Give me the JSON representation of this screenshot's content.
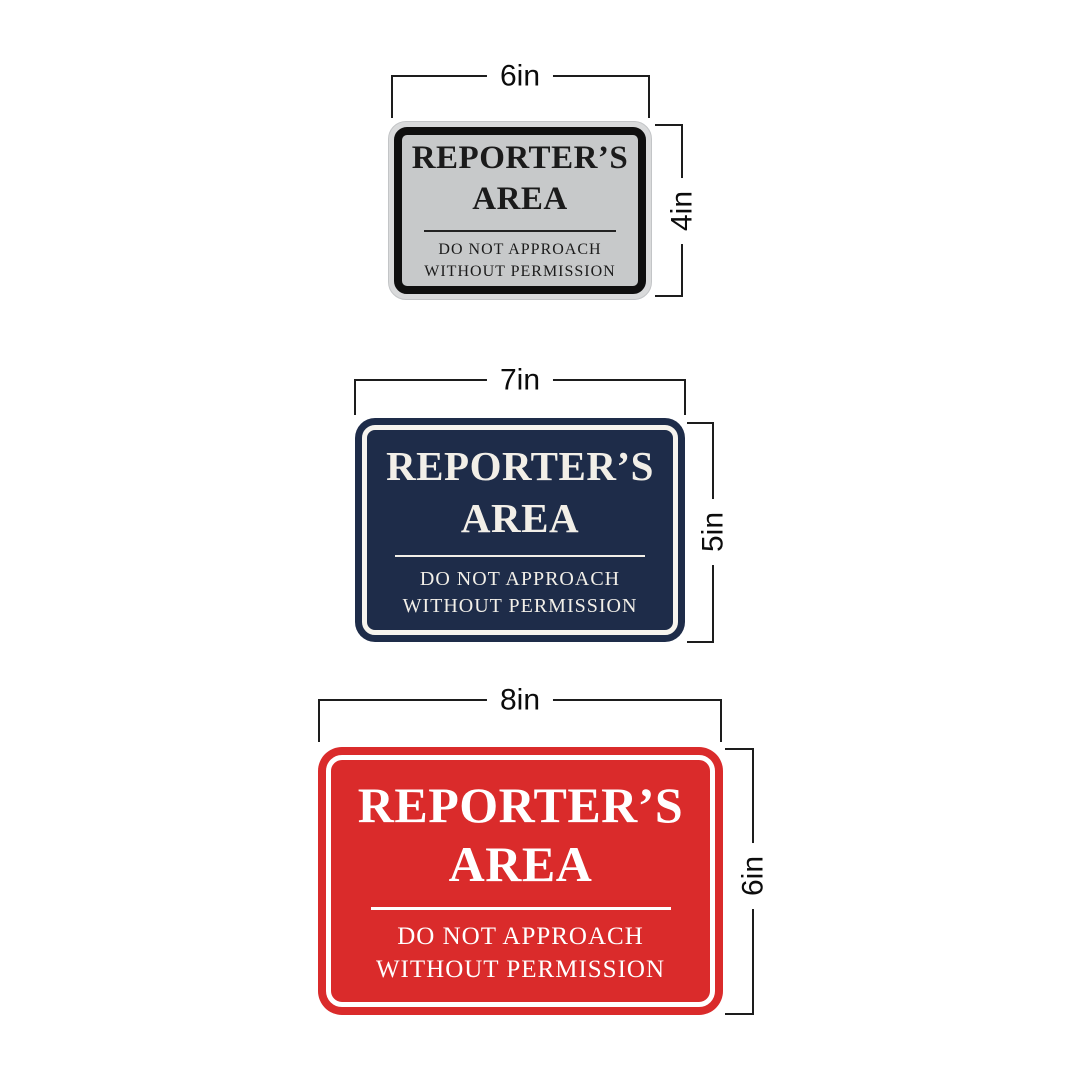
{
  "canvas": {
    "background": "#ffffff",
    "dimension_line_color": "#1d1d1d",
    "dimension_label_color": "#0c0c0c"
  },
  "signs": [
    {
      "name": "silver-sign-6x4",
      "width_label": "6in",
      "height_label": "4in",
      "title_line1": "REPORTER’S",
      "title_line2": "AREA",
      "subtitle_line1": "DO NOT APPROACH",
      "subtitle_line2": "WITHOUT PERMISSION",
      "colors": {
        "frame": "#d9dadb",
        "border": "#0f0f0f",
        "face": "#c7c9ca",
        "text": "#1b1b1b",
        "divider": "#222222"
      }
    },
    {
      "name": "navy-sign-7x5",
      "width_label": "7in",
      "height_label": "5in",
      "title_line1": "REPORTER’S",
      "title_line2": "AREA",
      "subtitle_line1": "DO NOT APPROACH",
      "subtitle_line2": "WITHOUT PERMISSION",
      "colors": {
        "face": "#1e2c49",
        "stripe": "#f7f4ee",
        "text": "#f2efe8",
        "divider": "#f2efe8"
      }
    },
    {
      "name": "red-sign-8x6",
      "width_label": "8in",
      "height_label": "6in",
      "title_line1": "REPORTER’S",
      "title_line2": "AREA",
      "subtitle_line1": "DO NOT APPROACH",
      "subtitle_line2": "WITHOUT PERMISSION",
      "colors": {
        "face": "#da2b2b",
        "stripe": "#ffffff",
        "text": "#ffffff",
        "divider": "#ffffff"
      }
    }
  ]
}
